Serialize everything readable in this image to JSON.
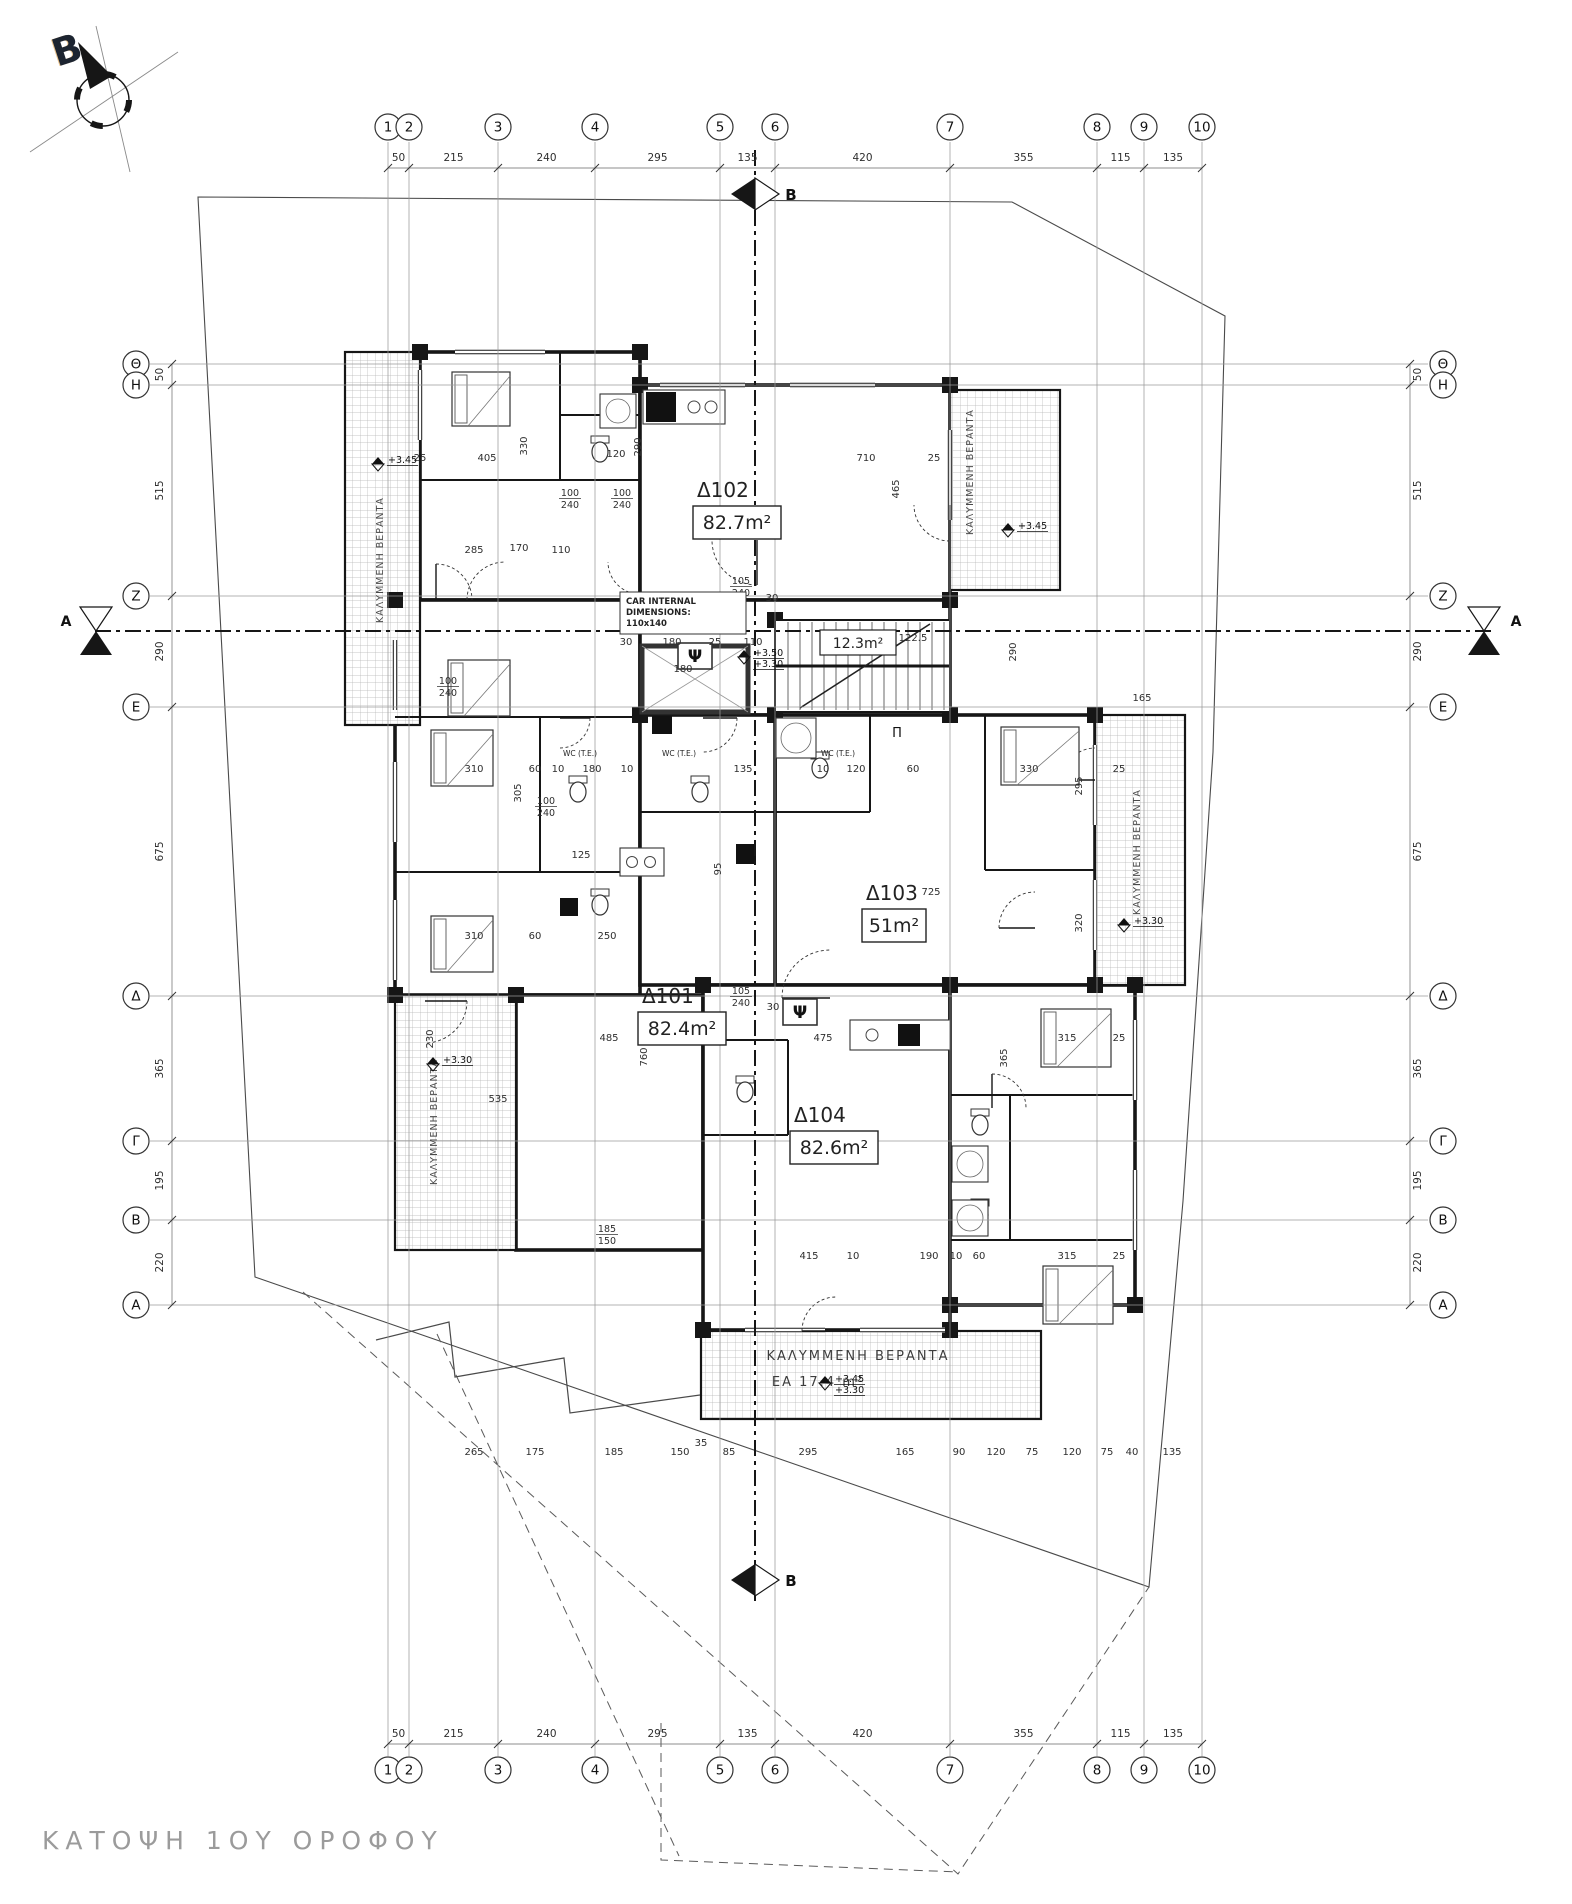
{
  "meta": {
    "title_block": "ΚΑΤΟΨΗ 1ΟΥ ΟΡΟΦΟΥ",
    "north_label": "B"
  },
  "sections": {
    "horizontal_label": "A",
    "vertical_label": "B"
  },
  "grid": {
    "columns": [
      {
        "label": "1",
        "x": 388
      },
      {
        "label": "2",
        "x": 409
      },
      {
        "label": "3",
        "x": 498
      },
      {
        "label": "4",
        "x": 595
      },
      {
        "label": "5",
        "x": 720
      },
      {
        "label": "6",
        "x": 775
      },
      {
        "label": "7",
        "x": 950
      },
      {
        "label": "8",
        "x": 1097
      },
      {
        "label": "9",
        "x": 1144
      },
      {
        "label": "10",
        "x": 1202
      }
    ],
    "rows": [
      {
        "label": "Θ",
        "y": 364
      },
      {
        "label": "Η",
        "y": 385
      },
      {
        "label": "Ζ",
        "y": 596
      },
      {
        "label": "Ε",
        "y": 707
      },
      {
        "label": "Δ",
        "y": 996
      },
      {
        "label": "Γ",
        "y": 1141
      },
      {
        "label": "Β",
        "y": 1220
      },
      {
        "label": "Α",
        "y": 1305
      }
    ],
    "top_dims": [
      "50",
      "215",
      "240",
      "295",
      "135",
      "420",
      "355",
      "115",
      "135"
    ],
    "bottom_dims": [
      "50",
      "215",
      "240",
      "295",
      "135",
      "420",
      "355",
      "115",
      "135"
    ],
    "left_dims": [
      "50",
      "515",
      "290",
      "675",
      "365",
      "195",
      "220"
    ],
    "right_dims": [
      "50",
      "515",
      "290",
      "675",
      "365",
      "195",
      "220"
    ]
  },
  "apartments": [
    {
      "name": "Δ101",
      "area": "82.4m²",
      "x": 638,
      "y": 1003
    },
    {
      "name": "Δ102",
      "area": "82.7m²",
      "x": 693,
      "y": 497
    },
    {
      "name": "Δ103",
      "area": "51m²",
      "x": 862,
      "y": 900
    },
    {
      "name": "Δ104",
      "area": "82.6m²",
      "x": 790,
      "y": 1122
    }
  ],
  "stairwell": {
    "area": "12.3m²",
    "x": 820,
    "y": 630
  },
  "elevator_note": {
    "lines": [
      "CAR INTERNAL",
      "DIMENSIONS:",
      "110x140"
    ],
    "x": 620,
    "y": 592
  },
  "elevator_width_dim": "180",
  "wc_label": "WC (T.E.)",
  "wc_positions": [
    [
      580,
      756
    ],
    [
      679,
      756
    ],
    [
      838,
      756
    ]
  ],
  "balcony_label": "ΚΑΛΥΜΜΕΝΗ ΒΕΡΑΝΤΑ",
  "balcony_bottom": {
    "line1": "ΚΑΛΥΜΜΕΝΗ ΒΕΡΑΝΤΑ",
    "line2": "ΕΑ  17.4 m²",
    "x": 858,
    "y": 1360
  },
  "balcony_label_positions": [
    {
      "x": 383,
      "y": 560
    },
    {
      "x": 973,
      "y": 472
    },
    {
      "x": 1140,
      "y": 852
    },
    {
      "x": 437,
      "y": 1122
    }
  ],
  "fixture_glyphs": {
    "psi": "Ψ",
    "pi": "Π"
  },
  "psi_positions": [
    [
      695,
      662
    ],
    [
      800,
      1018
    ]
  ],
  "pi_position": [
    897,
    737
  ],
  "levels": [
    {
      "lines": [
        "+3.45"
      ],
      "x": 378,
      "y": 464
    },
    {
      "lines": [
        "+3.45"
      ],
      "x": 1008,
      "y": 530
    },
    {
      "lines": [
        "+3.50",
        "+3.30"
      ],
      "x": 744,
      "y": 657
    },
    {
      "lines": [
        "+3.30"
      ],
      "x": 1124,
      "y": 925
    },
    {
      "lines": [
        "+3.30"
      ],
      "x": 433,
      "y": 1064
    },
    {
      "lines": [
        "+3.45",
        "+3.30"
      ],
      "x": 825,
      "y": 1383
    }
  ],
  "interior_dims": [
    {
      "t": "405",
      "x": 487,
      "y": 461
    },
    {
      "t": "25",
      "x": 420,
      "y": 461
    },
    {
      "t": "330",
      "x": 527,
      "y": 446,
      "r": 1
    },
    {
      "t": "120",
      "x": 616,
      "y": 457
    },
    {
      "t": "290",
      "x": 641,
      "y": 447,
      "r": 1
    },
    {
      "t": "710",
      "x": 866,
      "y": 461
    },
    {
      "t": "25",
      "x": 934,
      "y": 461
    },
    {
      "t": "465",
      "x": 899,
      "y": 489,
      "r": 1
    },
    {
      "t": "285",
      "x": 474,
      "y": 553
    },
    {
      "t": "170",
      "x": 519,
      "y": 551
    },
    {
      "t": "110",
      "x": 561,
      "y": 553
    },
    {
      "t": "100",
      "b": "240",
      "x": 570,
      "y": 496
    },
    {
      "t": "100",
      "b": "240",
      "x": 622,
      "y": 496
    },
    {
      "t": "105",
      "b": "240",
      "x": 741,
      "y": 584
    },
    {
      "t": "30",
      "x": 772,
      "y": 601
    },
    {
      "t": "30",
      "x": 626,
      "y": 645
    },
    {
      "t": "180",
      "x": 672,
      "y": 645
    },
    {
      "t": "25",
      "x": 715,
      "y": 645
    },
    {
      "t": "110",
      "x": 753,
      "y": 645
    },
    {
      "t": "122.5",
      "x": 913,
      "y": 641
    },
    {
      "t": "290",
      "x": 1016,
      "y": 652,
      "r": 1
    },
    {
      "t": "165",
      "x": 1142,
      "y": 701
    },
    {
      "t": "100",
      "b": "240",
      "x": 448,
      "y": 684
    },
    {
      "t": "305",
      "x": 521,
      "y": 793,
      "r": 1
    },
    {
      "t": "310",
      "x": 474,
      "y": 772
    },
    {
      "t": "60",
      "x": 535,
      "y": 772
    },
    {
      "t": "10",
      "x": 558,
      "y": 772
    },
    {
      "t": "180",
      "x": 592,
      "y": 772
    },
    {
      "t": "10",
      "x": 627,
      "y": 772
    },
    {
      "t": "135",
      "x": 743,
      "y": 772
    },
    {
      "t": "10",
      "x": 823,
      "y": 772
    },
    {
      "t": "120",
      "x": 856,
      "y": 772
    },
    {
      "t": "60",
      "x": 913,
      "y": 772
    },
    {
      "t": "330",
      "x": 1029,
      "y": 772
    },
    {
      "t": "25",
      "x": 1119,
      "y": 772
    },
    {
      "t": "295",
      "x": 1082,
      "y": 786,
      "r": 1
    },
    {
      "t": "125",
      "x": 581,
      "y": 858
    },
    {
      "t": "95",
      "x": 721,
      "y": 869,
      "r": 1
    },
    {
      "t": "100",
      "b": "240",
      "x": 546,
      "y": 804
    },
    {
      "t": "725",
      "x": 931,
      "y": 895
    },
    {
      "t": "320",
      "x": 1082,
      "y": 923,
      "r": 1
    },
    {
      "t": "310",
      "x": 474,
      "y": 939
    },
    {
      "t": "60",
      "x": 535,
      "y": 939
    },
    {
      "t": "250",
      "x": 607,
      "y": 939
    },
    {
      "t": "105",
      "b": "240",
      "x": 741,
      "y": 994
    },
    {
      "t": "30",
      "x": 773,
      "y": 1010
    },
    {
      "t": "485",
      "x": 609,
      "y": 1041
    },
    {
      "t": "25",
      "x": 716,
      "y": 1041
    },
    {
      "t": "475",
      "x": 823,
      "y": 1041
    },
    {
      "t": "315",
      "x": 1067,
      "y": 1041
    },
    {
      "t": "25",
      "x": 1119,
      "y": 1041
    },
    {
      "t": "365",
      "x": 1007,
      "y": 1058,
      "r": 1
    },
    {
      "t": "230",
      "x": 433,
      "y": 1039,
      "r": 1
    },
    {
      "t": "760",
      "x": 647,
      "y": 1057,
      "r": 1
    },
    {
      "t": "535",
      "x": 498,
      "y": 1102
    },
    {
      "t": "755",
      "x": 853,
      "y": 1149,
      "r": 1
    },
    {
      "t": "185",
      "b": "150",
      "x": 607,
      "y": 1232
    },
    {
      "t": "415",
      "x": 809,
      "y": 1259
    },
    {
      "t": "10",
      "x": 853,
      "y": 1259
    },
    {
      "t": "190",
      "x": 929,
      "y": 1259
    },
    {
      "t": "10",
      "x": 956,
      "y": 1259
    },
    {
      "t": "60",
      "x": 979,
      "y": 1259
    },
    {
      "t": "315",
      "x": 1067,
      "y": 1259
    },
    {
      "t": "25",
      "x": 1119,
      "y": 1259
    },
    {
      "t": "35",
      "x": 701,
      "y": 1446
    },
    {
      "t": "265",
      "x": 474,
      "y": 1455
    },
    {
      "t": "175",
      "x": 535,
      "y": 1455
    },
    {
      "t": "185",
      "x": 614,
      "y": 1455
    },
    {
      "t": "150",
      "x": 680,
      "y": 1455
    },
    {
      "t": "85",
      "x": 729,
      "y": 1455
    },
    {
      "t": "295",
      "x": 808,
      "y": 1455
    },
    {
      "t": "165",
      "x": 905,
      "y": 1455
    },
    {
      "t": "90",
      "x": 959,
      "y": 1455
    },
    {
      "t": "120",
      "x": 996,
      "y": 1455
    },
    {
      "t": "75",
      "x": 1032,
      "y": 1455
    },
    {
      "t": "120",
      "x": 1072,
      "y": 1455
    },
    {
      "t": "75",
      "x": 1107,
      "y": 1455
    },
    {
      "t": "40",
      "x": 1132,
      "y": 1455
    },
    {
      "t": "135",
      "x": 1172,
      "y": 1455
    }
  ],
  "colors": {
    "ink": "#161616",
    "grid": "#9a9a9a",
    "dim": "#2e2e2e",
    "hatch": "#b5b5b5",
    "title": "#9b9b9b"
  }
}
